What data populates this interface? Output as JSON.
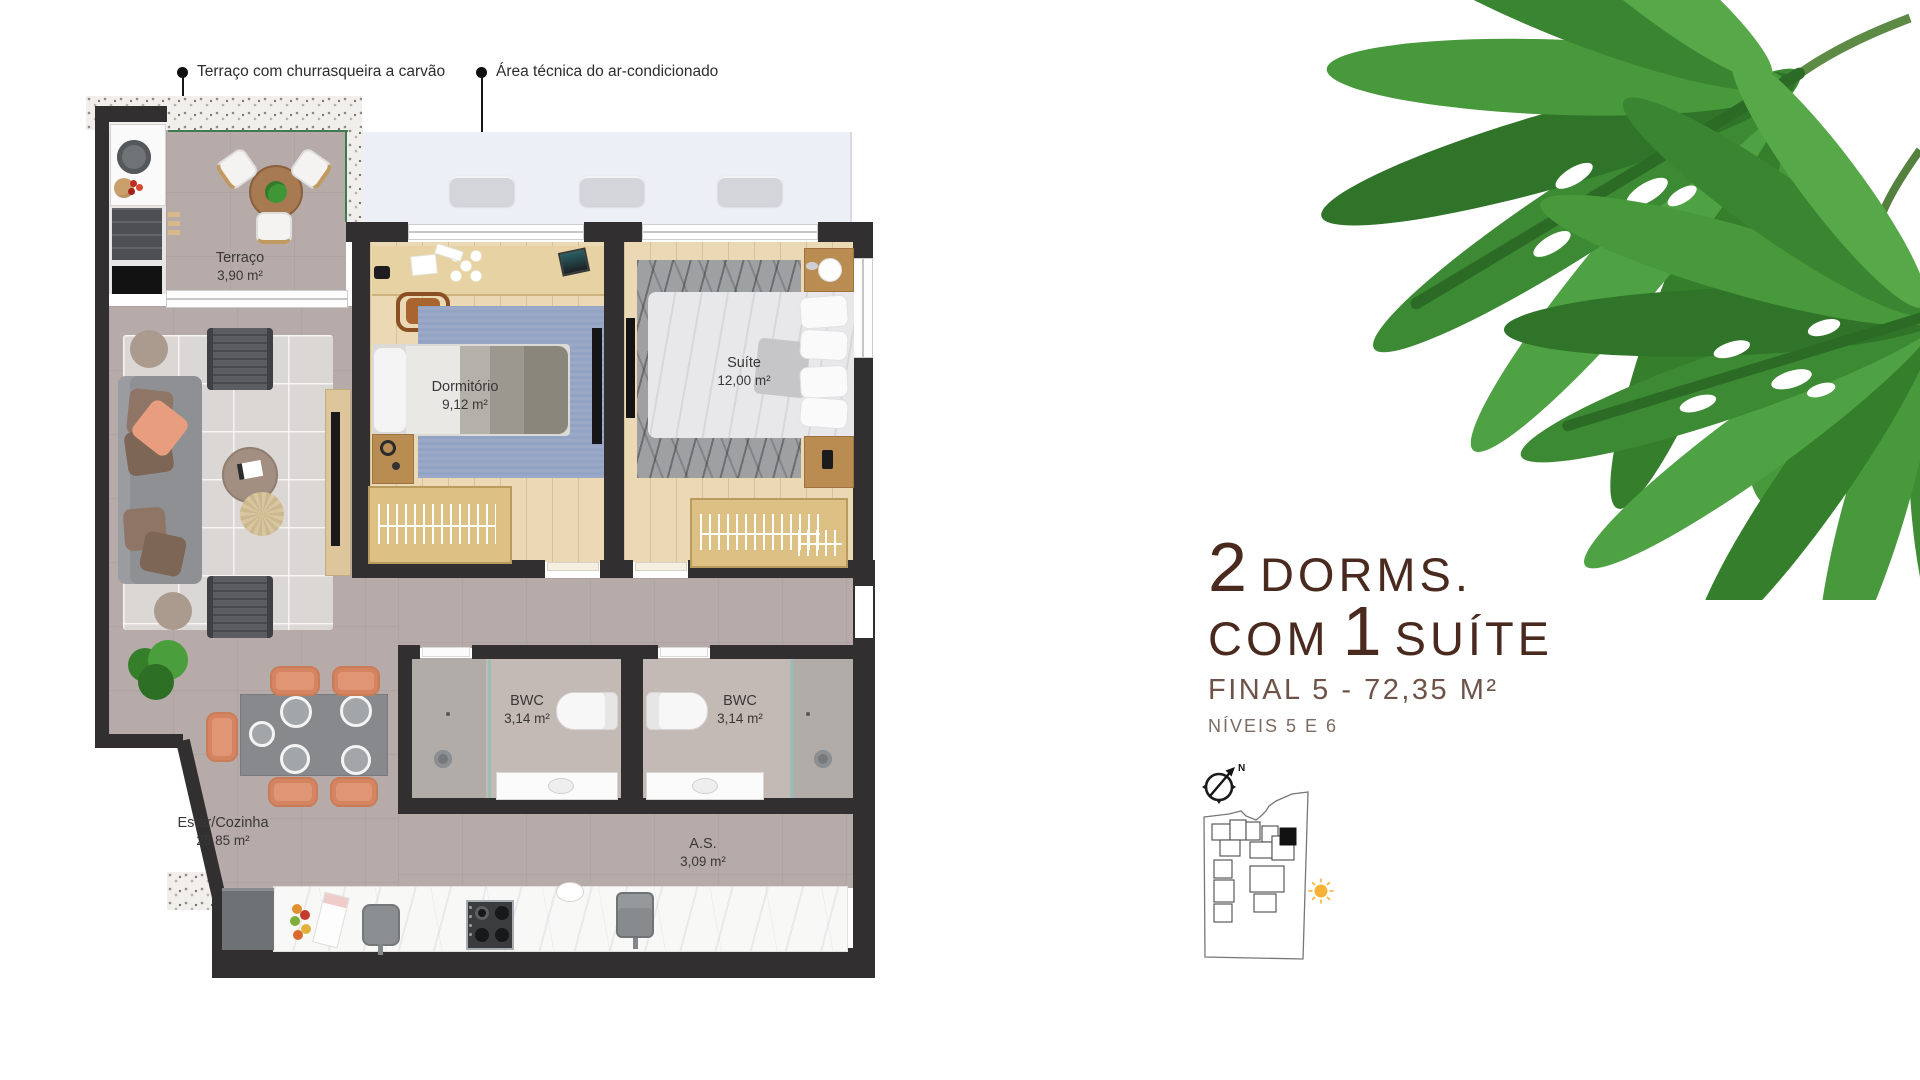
{
  "callouts": [
    {
      "label": "Terraço com churrasqueira a carvão"
    },
    {
      "label": "Área técnica do ar-condicionado"
    }
  ],
  "rooms": {
    "terraco": {
      "name": "Terraço",
      "area": "3,90 m²"
    },
    "dormitorio": {
      "name": "Dormitório",
      "area": "9,12 m²"
    },
    "suite": {
      "name": "Suíte",
      "area": "12,00 m²"
    },
    "bwc1": {
      "name": "BWC",
      "area": "3,14 m²"
    },
    "bwc2": {
      "name": "BWC",
      "area": "3,14 m²"
    },
    "estar_cozinha": {
      "name": "Estar/Cozinha",
      "area": "25,85 m²"
    },
    "area_servico": {
      "name": "A.S.",
      "area": "3,09 m²"
    }
  },
  "unit_info": {
    "dorms_count": "2",
    "dorms_word": "DORMS.",
    "com_word": "COM",
    "suite_count": "1",
    "suite_word": "SUÍTE",
    "final_line": "FINAL 5 - 72,35 M²",
    "levels_line": "NÍVEIS 5 E 6"
  },
  "compass": {
    "north_label": "N"
  },
  "colors": {
    "heading_brown": "#4a2a1f",
    "wall_dark": "#312f30",
    "floor_mauve": "#b7abaa",
    "wood_light": "#ead9b4",
    "terracotta_chair": "#e09674",
    "leaf_green": "#4b9440",
    "sun_yellow": "#f5b237",
    "glass_green": "#8fc0b6"
  }
}
